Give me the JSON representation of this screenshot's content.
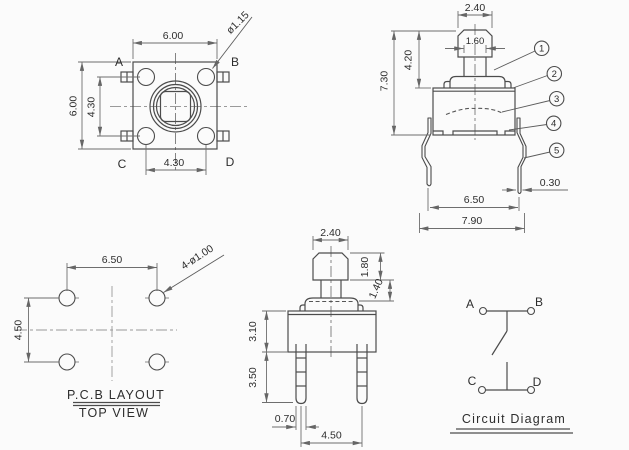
{
  "drawing": {
    "background_color": "#fbfbfb",
    "line_color": "#4c4c4c",
    "dimension_color": "#6e6e6e",
    "centerline_color": "#9a9a9a",
    "top_view": {
      "labels": {
        "a": "A",
        "b": "B",
        "c": "C",
        "d": "D"
      },
      "dims": {
        "width_top": "6.00",
        "height_left": "6.00",
        "pin_span_vertical": "4.30",
        "pin_span_horizontal": "4.30",
        "pin_diameter": "ø1.15"
      }
    },
    "front_view": {
      "dims": {
        "cap_width": "2.40",
        "stem_width": "1.60",
        "total_height": "7.30",
        "plunger_height": "4.20",
        "leg_span": "6.50",
        "overall_width": "7.90",
        "leg_thickness": "0.30"
      },
      "callouts": [
        "1",
        "2",
        "3",
        "4",
        "5"
      ]
    },
    "pcb_layout": {
      "dims": {
        "hole_span_horizontal": "6.50",
        "hole_span_vertical": "4.50",
        "hole_callout": "4-ø1.00"
      },
      "caption_line1": "P.C.B LAYOUT",
      "caption_line2": "TOP VIEW"
    },
    "side_view": {
      "dims": {
        "cap_width": "2.40",
        "cap_height": "1.80",
        "stem_height": "1.40",
        "body_height": "3.10",
        "pin_length": "3.50",
        "pin_width": "0.70",
        "pin_span": "4.50"
      }
    },
    "circuit": {
      "terminals": {
        "a": "A",
        "b": "B",
        "c": "C",
        "d": "D"
      },
      "caption": "Circuit Diagram"
    }
  }
}
